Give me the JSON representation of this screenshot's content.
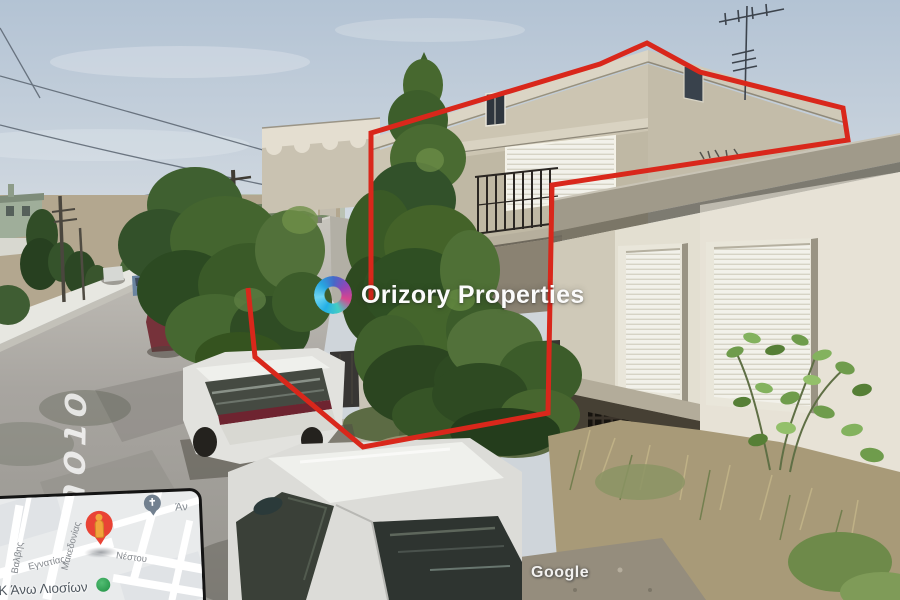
{
  "watermark": {
    "brand": "Orizory Properties"
  },
  "road_painted_label": "οτου",
  "google_watermark": "Google",
  "annotation": {
    "boundary_color": "#d9271b"
  },
  "map_inset": {
    "street_labels": [
      "Βαλβης",
      "Μακεδονίας",
      "Εγνατίας",
      "Νέστου"
    ],
    "area_label": "Κ Άνω Λιοσίων",
    "partial_label": "Άν",
    "church_cross_glyph": "✝"
  },
  "colors": {
    "sky_top": "#b7c6d6",
    "sky_bottom": "#dde3e9",
    "marker_red": "#e94335",
    "marker_green": "#2da44e",
    "church_pin_gray": "#72808f"
  }
}
